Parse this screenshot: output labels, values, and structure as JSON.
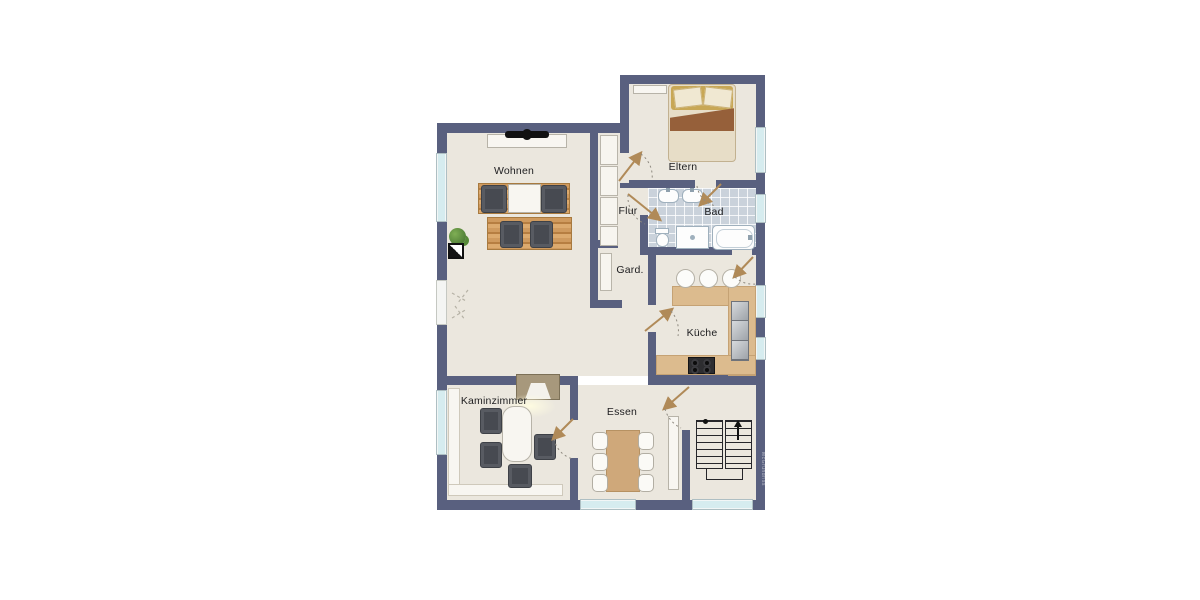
{
  "rooms": {
    "wohnen": {
      "label": "Wohnen"
    },
    "eltern": {
      "label": "Eltern"
    },
    "flur": {
      "label": "Flur"
    },
    "bad": {
      "label": "Bad"
    },
    "gard": {
      "label": "Gard."
    },
    "kueche": {
      "label": "Küche"
    },
    "kaminzimmer": {
      "label": "Kaminzimmer"
    },
    "essen": {
      "label": "Essen"
    }
  },
  "watermark": {
    "label": "McGrundriss"
  },
  "colors": {
    "wall": "#59607f",
    "floor": "#ebe7de",
    "bath_tile": "#cad2db",
    "window_glass": "#d6ecef",
    "kitchen_counter": "#dcbb8e",
    "wood_furniture": "#c9955c",
    "cushion_dark": "#585b62",
    "door_arrow": "#b08a58",
    "background": "#ffffff"
  }
}
